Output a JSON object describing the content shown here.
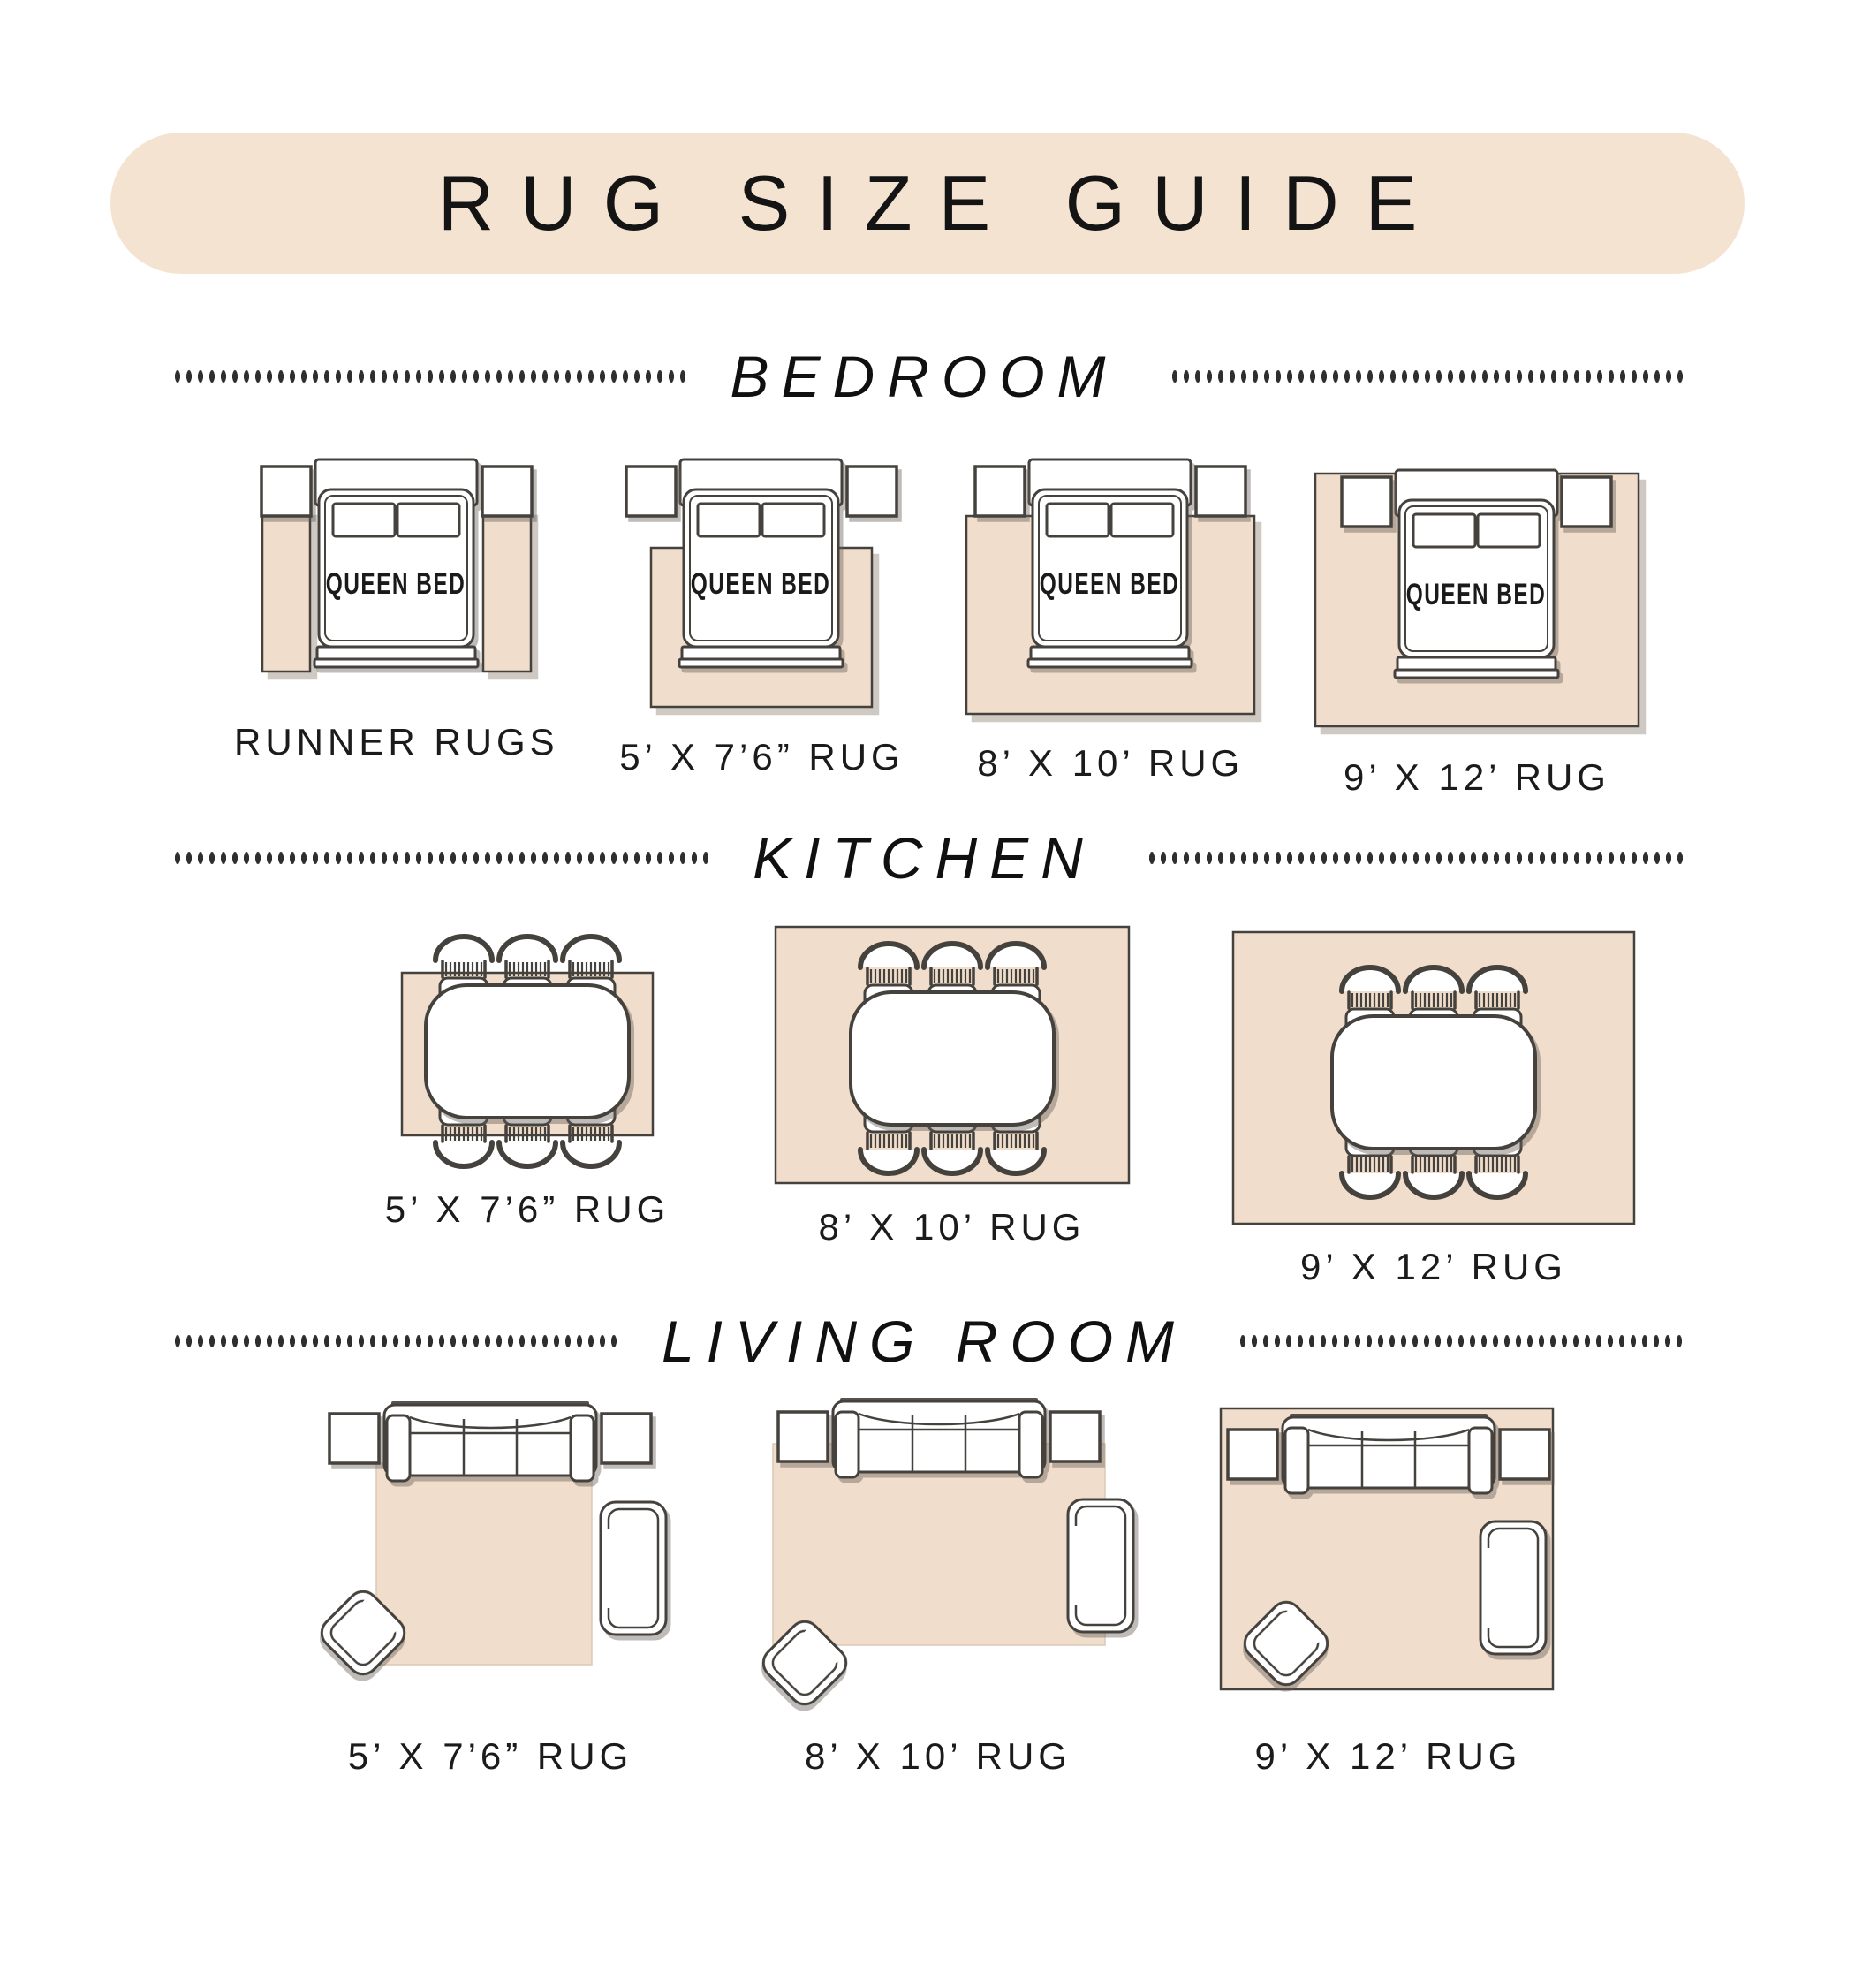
{
  "title": "RUG SIZE GUIDE",
  "bed_label": "QUEEN BED",
  "sections": [
    {
      "heading": "BEDROOM",
      "items": [
        {
          "label": "RUNNER RUGS"
        },
        {
          "label": "5’ X 7’6” RUG"
        },
        {
          "label": "8’ X 10’ RUG"
        },
        {
          "label": "9’ X 12’ RUG"
        }
      ]
    },
    {
      "heading": "KITCHEN",
      "items": [
        {
          "label": "5’ X 7’6” RUG"
        },
        {
          "label": "8’ X 10’ RUG"
        },
        {
          "label": "9’ X 12’ RUG"
        }
      ]
    },
    {
      "heading": "LIVING ROOM",
      "items": [
        {
          "label": "5’ X 7’6” RUG"
        },
        {
          "label": "8’ X 10’ RUG"
        },
        {
          "label": "9’ X 12’ RUG"
        }
      ]
    }
  ],
  "colors": {
    "banner": "#F5E3D2",
    "rug": "#F0DDCB",
    "outline": "#45423E",
    "text": "#1A1A1A"
  }
}
